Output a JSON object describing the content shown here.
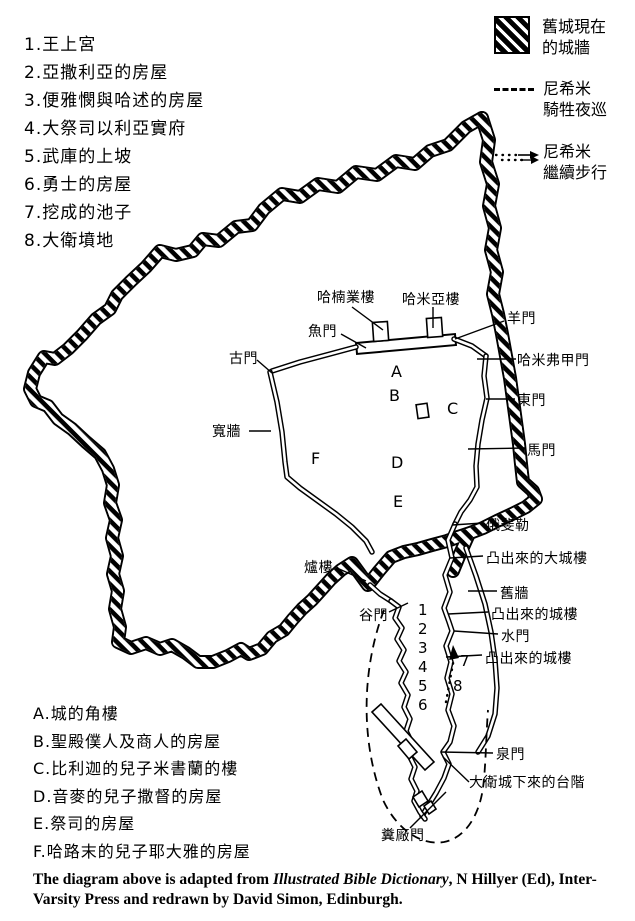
{
  "page": {
    "background": "#ffffff",
    "ink": "#000000"
  },
  "numbered_list": [
    "1.王上宮",
    "2.亞撒利亞的房屋",
    "3.便雅憫與哈述的房屋",
    "4.大祭司以利亞實府",
    "5.武庫的上坡",
    "6.勇士的房屋",
    "7.挖成的池子",
    "8.大衛墳地"
  ],
  "legend": {
    "items": [
      {
        "icon": "hatched-swatch",
        "lines": [
          "舊城現在",
          "的城牆"
        ]
      },
      {
        "icon": "dashed-line",
        "lines": [
          "尼希米",
          "騎牲夜巡"
        ]
      },
      {
        "icon": "dotted-arrow",
        "lines": [
          "尼希米",
          "繼續步行"
        ]
      }
    ]
  },
  "map_labels": {
    "tower_hananel": "哈楠業樓",
    "tower_hammeah": "哈米亞樓",
    "fish_gate": "魚門",
    "old_gate": "古門",
    "sheep_gate": "羊門",
    "hammiphkad_gate": "哈米弗甲門",
    "east_gate": "東門",
    "horse_gate": "馬門",
    "broad_wall": "寬牆",
    "ophel": "俄斐勒",
    "projecting_great_tower": "凸出來的大城樓",
    "old_wall": "舊牆",
    "projecting_tower_upper": "凸出來的城樓",
    "water_gate": "水門",
    "projecting_tower_lower": "凸出來的城樓",
    "furnace_tower": "爐樓",
    "valley_gate": "谷門",
    "fountain_gate": "泉門",
    "stairs_city_of_david": "大衛城下來的台階",
    "dung_gate": "糞廠門"
  },
  "markers": {
    "area_letters": [
      "A",
      "B",
      "C",
      "D",
      "E",
      "F"
    ],
    "route_numbers": [
      "1",
      "2",
      "3",
      "4",
      "5",
      "6"
    ],
    "route_number_7": "7",
    "route_number_8": "8"
  },
  "lettered_list": [
    "A.城的角樓",
    "B.聖殿僕人及商人的房屋",
    "C.比利迦的兒子米書蘭的樓",
    "D.音麥的兒子撒督的房屋",
    "E.祭司的房屋",
    "F.哈路末的兒子耶大雅的房屋"
  ],
  "caption": {
    "pre": "The diagram above is adapted from ",
    "italic": "Illustrated Bible Dictionary",
    "post": ", N Hillyer (Ed), Inter-Varsity Press and redrawn by David Simon, Edinburgh."
  }
}
